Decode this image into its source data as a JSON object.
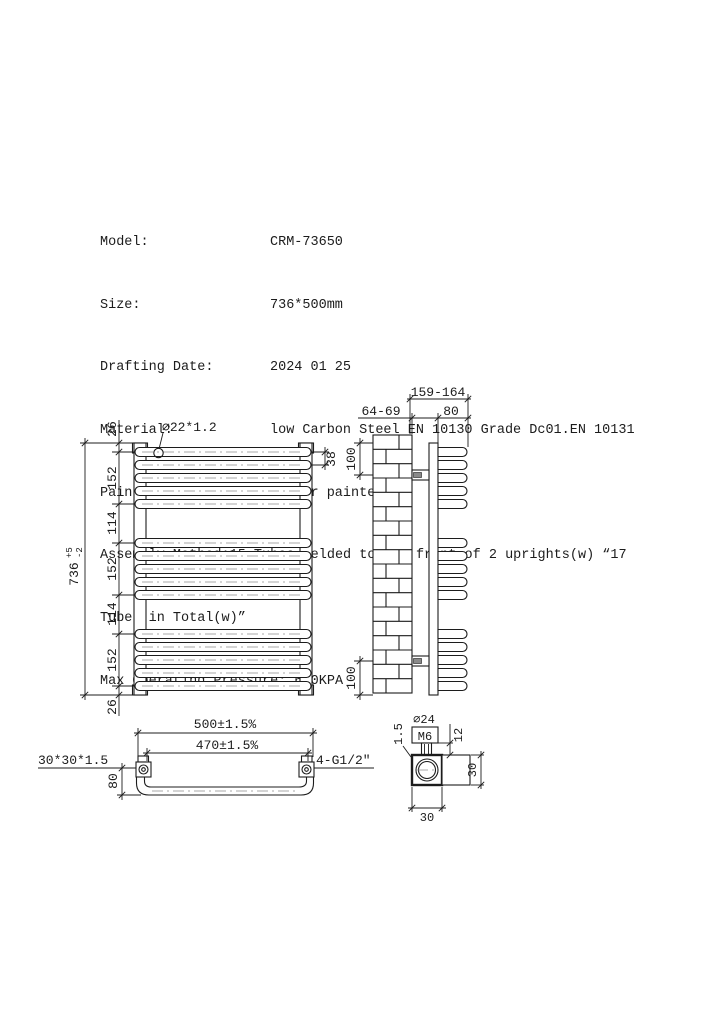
{
  "spec": {
    "rows": [
      {
        "label": "Model:",
        "value": "CRM-73650"
      },
      {
        "label": "Size:",
        "value": "736*500mm"
      },
      {
        "label": "Drafting Date:",
        "value": "2024 01 25"
      },
      {
        "label": "Material:",
        "value": "low Carbon Steel EN 10130 Grade Dc01.EN 10131"
      },
      {
        "label": "Painted Models:",
        "value": "Powder painted"
      }
    ],
    "assembly_line1": "Assembly Method:15 Tubes Welded to the front of 2 uprights(w) “17",
    "assembly_line2": "Tubes in Total(w)”",
    "max_pressure": "Max Operating Pressure: 600KPA"
  },
  "front_view": {
    "tube_label": "⌀22*1.2",
    "tube_spacing": "38",
    "height_total": "736",
    "height_tol_plus": "+5",
    "height_tol_minus": "-2",
    "segments": [
      "26",
      "152",
      "114",
      "152",
      "114",
      "152",
      "26"
    ]
  },
  "side_view": {
    "depth_range": "159-164",
    "wall_gap": "64-69",
    "tube_depth": "80",
    "bracket_top": "100",
    "bracket_bottom": "100"
  },
  "bottom_view": {
    "width_outer": "500±1.5%",
    "width_inner": "470±1.5%",
    "upright_profile": "30*30*1.5",
    "connections": "4-G1/2″",
    "tube_drop": "80"
  },
  "detail_view": {
    "washer_dia": "⌀24",
    "thread": "M6",
    "plate_thickness": "1.5",
    "bolt_height": "12",
    "bracket_height": "30",
    "bracket_width": "30"
  },
  "colors": {
    "line": "#1c1c1c",
    "background": "#ffffff"
  }
}
